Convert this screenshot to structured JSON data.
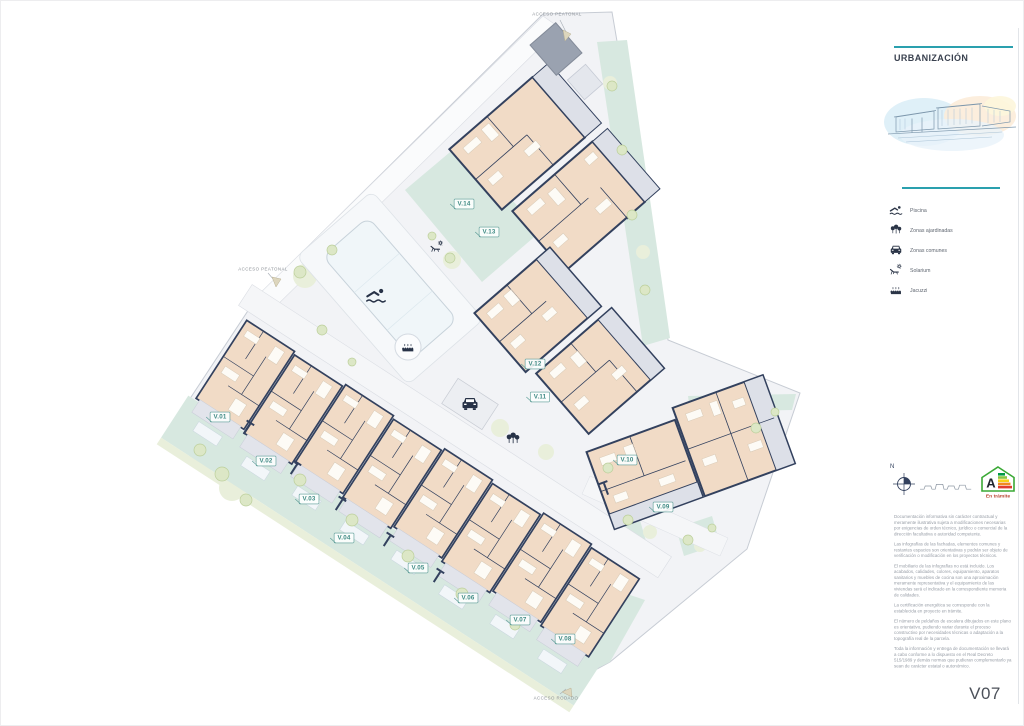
{
  "page": {
    "sheet_code": "V07"
  },
  "plan": {
    "access_labels": [
      {
        "id": "top",
        "text": "ACCESO PEATONAL"
      },
      {
        "id": "left",
        "text": "ACCESO PEATONAL"
      },
      {
        "id": "bottom",
        "text": "ACCESO RODADO"
      }
    ],
    "villas": [
      {
        "id": "V.01",
        "x": 220,
        "y": 417
      },
      {
        "id": "V.02",
        "x": 266,
        "y": 461
      },
      {
        "id": "V.03",
        "x": 309,
        "y": 499
      },
      {
        "id": "V.04",
        "x": 344,
        "y": 538
      },
      {
        "id": "V.05",
        "x": 418,
        "y": 568
      },
      {
        "id": "V.06",
        "x": 468,
        "y": 598
      },
      {
        "id": "V.07",
        "x": 520,
        "y": 620
      },
      {
        "id": "V.08",
        "x": 565,
        "y": 639
      },
      {
        "id": "V.09",
        "x": 663,
        "y": 507
      },
      {
        "id": "V.10",
        "x": 627,
        "y": 460
      },
      {
        "id": "V.11",
        "x": 540,
        "y": 397
      },
      {
        "id": "V.12",
        "x": 535,
        "y": 364
      },
      {
        "id": "V.13",
        "x": 489,
        "y": 232
      },
      {
        "id": "V.14",
        "x": 464,
        "y": 204
      }
    ],
    "map_icons": [
      {
        "icon": "swimmer-icon",
        "x": 376,
        "y": 295
      },
      {
        "icon": "jacuzzi-icon",
        "x": 408,
        "y": 347
      },
      {
        "icon": "sun-lounger-icon",
        "x": 437,
        "y": 247
      },
      {
        "icon": "car-icon",
        "x": 470,
        "y": 404
      },
      {
        "icon": "trees-icon",
        "x": 513,
        "y": 439
      }
    ]
  },
  "sidebar": {
    "title": "URBANIZACIÓN",
    "legend": [
      {
        "icon": "swimmer-icon",
        "label": "Piscina"
      },
      {
        "icon": "trees-icon",
        "label": "Zonas ajardinadas"
      },
      {
        "icon": "car-icon",
        "label": "Zonas comunes"
      },
      {
        "icon": "sun-lounger-icon",
        "label": "Solarium"
      },
      {
        "icon": "jacuzzi-icon",
        "label": "Jacuzzi"
      }
    ],
    "compass": {
      "label": "N"
    },
    "energy_rating": {
      "letter": "A",
      "status": "En trámite"
    },
    "disclaimer": [
      "Documentación informativa sin carácter contractual y meramente ilustrativa sujeta a modificaciones necesarias por exigencias de orden técnico, jurídico o comercial de la dirección facultativa o autoridad competente.",
      "Las infografías de las fachadas, elementos comunes y restantes espacios son orientativas y podrán ser objeto de verificación o modificación en los proyectos técnicos.",
      "El mobiliario de las infografías no está incluido. Los acabados, calidades, colores, equipamiento, aparatos sanitarios y muebles de cocina son una aproximación meramente representativa y el equipamiento de las viviendas será el indicado en la correspondiente memoria de calidades.",
      "La certificación energética se corresponde con la establecida en proyecto en trámite.",
      "El número de peldaños de escalera dibujados en este plano es orientativo, pudiendo variar durante el proceso constructivo por necesidades técnicas o adaptación a la topografía real de la parcela.",
      "Toda la información y entrega de documentación se llevará a cabo conforme a lo dispuesto en el Real Decreto 515/1989 y demás normas que pudieran complementarlo ya sean de carácter estatal o autonómico."
    ]
  },
  "colors": {
    "accent_teal": "#2aa0ae",
    "badge_teal": "#5a9b95",
    "wall_navy": "#33415e",
    "room_peach": "#f1dbc6",
    "terrace_gray": "#dde0e8",
    "garden_mint": "#d7e8e0",
    "green_soft": "#e9efdb",
    "tree_olive": "#dce7c6",
    "road_gray": "#f5f6f8",
    "text_gray": "#979da6",
    "energy_green": "#3aa935",
    "status_red": "#b8432f"
  }
}
